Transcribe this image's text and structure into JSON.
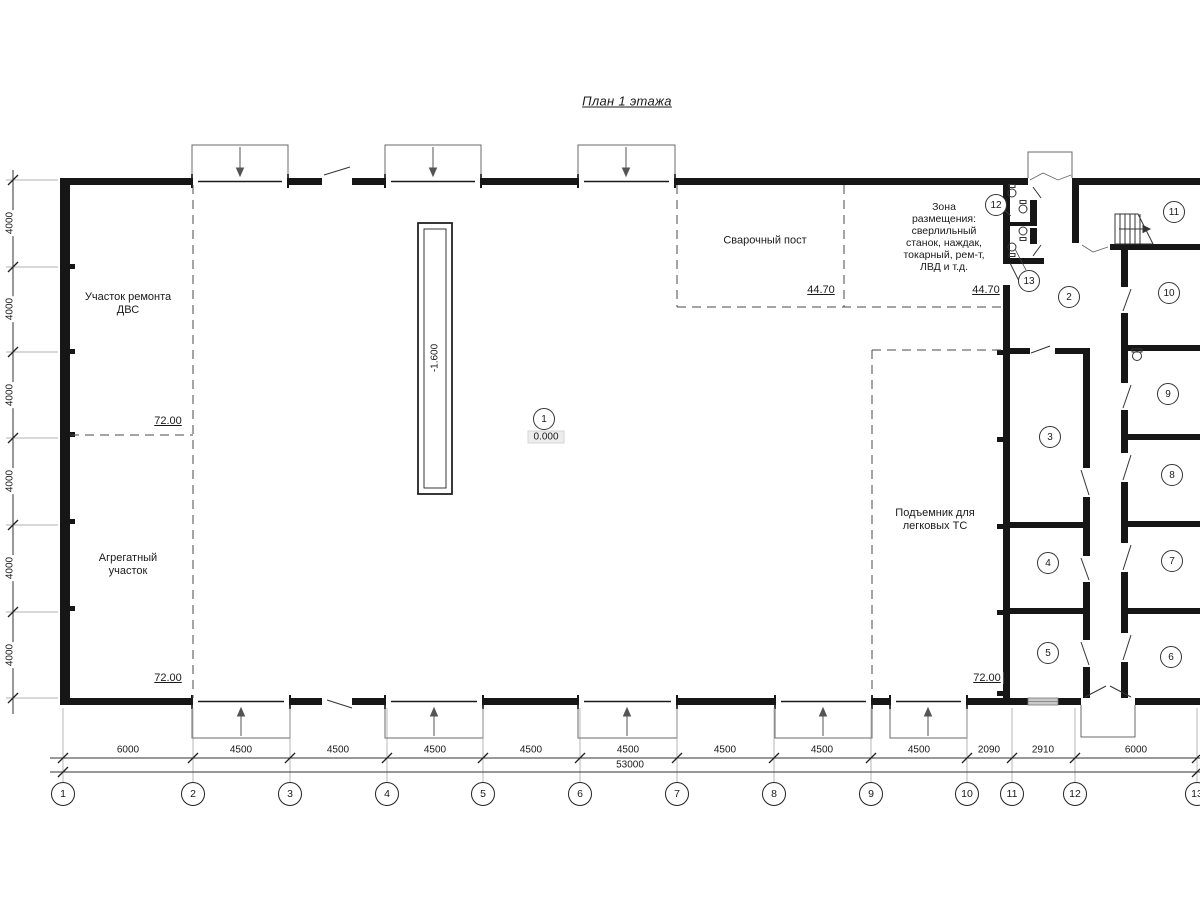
{
  "title": "План 1 этажа",
  "rooms": {
    "dvs": {
      "label": "Участок ремонта\nДВС",
      "elev": "72.00"
    },
    "aggregat": {
      "label": "Агрегатный\nучасток",
      "elev": "72.00"
    },
    "welding": {
      "label": "Сварочный пост",
      "elev": "44.70"
    },
    "tools": {
      "label": "Зона\nразмещения:\nсверлильный\nстанок, наждак,\nтокарный, рем-т,\nЛВД и т.д.",
      "elev": "44.70"
    },
    "lift": {
      "label": "Подъемник для\nлегковых ТС",
      "elev": "72.00"
    }
  },
  "marks": {
    "pit_depth": "-1.600",
    "floor_level": "0.000"
  },
  "room_numbers": [
    "1",
    "2",
    "3",
    "4",
    "5",
    "6",
    "7",
    "8",
    "9",
    "10",
    "11",
    "12",
    "13"
  ],
  "axes": [
    "1",
    "2",
    "3",
    "4",
    "5",
    "6",
    "7",
    "8",
    "9",
    "10",
    "11",
    "12",
    "13"
  ],
  "dims": {
    "bottom": [
      "6000",
      "4500",
      "4500",
      "4500",
      "4500",
      "4500",
      "4500",
      "4500",
      "4500",
      "2090",
      "2910",
      "6000"
    ],
    "total": "53000",
    "left": [
      "4000",
      "4000",
      "4000",
      "4000",
      "4000",
      "4000"
    ]
  }
}
